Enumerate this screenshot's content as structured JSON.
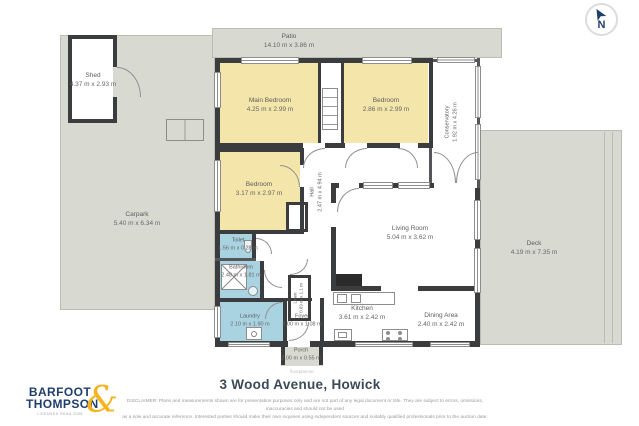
{
  "meta": {
    "address_title": "3 Wood Avenue, Howick",
    "watermark": "floorplanner"
  },
  "compass": {
    "label": "N"
  },
  "logo": {
    "line1": "BARFOOT",
    "line2": "THOMPSON",
    "ampersand": "&",
    "tagline": "LICENSED REAA 2008"
  },
  "disclaimer": {
    "line1": "DISCLAIMER: Plans and measurements shown are for presentation purposes only and are not part of any legal document or title. They are subject to errors, omissions, inaccuracies and should not be used",
    "line2": "as a sole and accurate reference. Interested parties should make their own inquiries using independent sources and suitably qualified professionals prior to the auction date."
  },
  "colors": {
    "brand_navy": "#1e3e6d",
    "brand_yellow": "#f5b41d",
    "room_yellow": "#f4e6aa",
    "room_blue": "#aad3e2",
    "outdoor_gray": "#d8dad2",
    "wall_dark": "#3b3c3e"
  },
  "rooms": {
    "patio": {
      "name": "Patio",
      "dims": "14.10 m x 3.86 m"
    },
    "shed": {
      "name": "Shed",
      "dims": "4.37 m x 2.93 m"
    },
    "carpark": {
      "name": "Carpark",
      "dims": "5.40 m x 6.34 m"
    },
    "main_bedroom": {
      "name": "Main Bedroom",
      "dims": "4.25 m x 2.99 m"
    },
    "bedroom_top": {
      "name": "Bedroom",
      "dims": "2.86 m x 2.99 m"
    },
    "conservatory": {
      "name": "Conservatory",
      "dims": "1.92 m x 4.26 m"
    },
    "bedroom_mid": {
      "name": "Bedroom",
      "dims": "3.17 m x 2.97 m"
    },
    "hall": {
      "name": "Hall",
      "dims": "2.47 m x 4.94 m"
    },
    "living_room": {
      "name": "Living Room",
      "dims": "5.04 m x 3.62 m"
    },
    "toilet": {
      "name": "Toilet",
      "dims": "1.56 m x 0.28 m"
    },
    "bathroom": {
      "name": "Bathroom",
      "dims": "2.48 m x 1.81 m"
    },
    "hall_cupboard": {
      "name": "Linen",
      "dims": "0.69 m x 1.1 m"
    },
    "laundry": {
      "name": "Laundry",
      "dims": "2.10 m x 1.90 m"
    },
    "foyer": {
      "name": "Foyer",
      "dims": "2.00 m x 1.08 m"
    },
    "porch": {
      "name": "Porch",
      "dims": "2.00 m x 0.55 m"
    },
    "kitchen": {
      "name": "Kitchen",
      "dims": "3.61 m x 2.42 m"
    },
    "dining": {
      "name": "Dining Area",
      "dims": "2.40 m x 2.42 m"
    },
    "deck": {
      "name": "Deck",
      "dims": "4.19 m x 7.35 m"
    }
  }
}
